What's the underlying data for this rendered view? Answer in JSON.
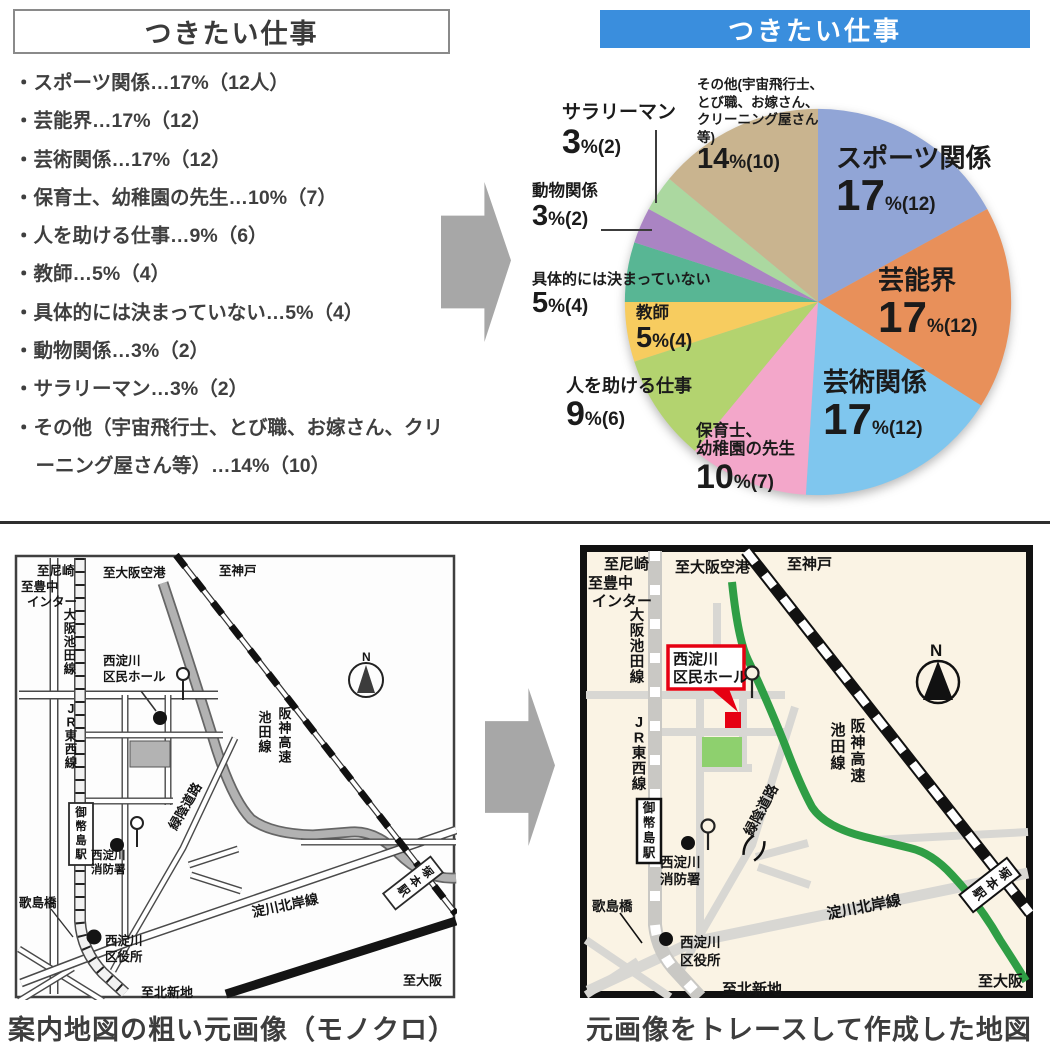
{
  "colors": {
    "header_blue": "#3a8edd",
    "map_green": "#2f9e45",
    "map_red": "#e60012",
    "park_green": "#8ed06e",
    "arrow_gray": "#a7a7a7"
  },
  "list_panel": {
    "title": "つきたい仕事",
    "items": [
      "スポーツ関係…17%（12人）",
      "芸能界…17%（12）",
      "芸術関係…17%（12）",
      "保育士、幼稚園の先生…10%（7）",
      "人を助ける仕事…9%（6）",
      "教師…5%（4）",
      "具体的には決まっていない…5%（4）",
      "動物関係…3%（2）",
      "サラリーマン…3%（2）",
      "その他（宇宙飛行士、とび職、お嫁さん、クリーニング屋さん等）…14%（10）"
    ]
  },
  "chart_header": {
    "title": "つきたい仕事"
  },
  "chart_data": {
    "type": "pie",
    "title": "つきたい仕事",
    "start_angle_deg": 0,
    "clockwise": true,
    "slices": [
      {
        "label": "スポーツ関係",
        "pct": 17,
        "count": 12,
        "big": "17",
        "small": "%(12)",
        "color": "#91a5d6"
      },
      {
        "label": "芸能界",
        "pct": 17,
        "count": 12,
        "big": "17",
        "small": "%(12)",
        "color": "#e8905a"
      },
      {
        "label": "芸術関係",
        "pct": 17,
        "count": 12,
        "big": "17",
        "small": "%(12)",
        "color": "#7fc6ee"
      },
      {
        "label": "保育士、幼稚園の先生",
        "pct": 10,
        "count": 7,
        "big": "10",
        "small": "%(7)",
        "color": "#f3a7ca",
        "label_lines": [
          "保育士、",
          "幼稚園の先生"
        ]
      },
      {
        "label": "人を助ける仕事",
        "pct": 9,
        "count": 6,
        "big": "9",
        "small": "%(6)",
        "color": "#b3d36f"
      },
      {
        "label": "教師",
        "pct": 5,
        "count": 4,
        "big": "5",
        "small": "%(4)",
        "color": "#f7cc5f"
      },
      {
        "label": "具体的には決まっていない",
        "pct": 5,
        "count": 4,
        "big": "5",
        "small": "%(4)",
        "color": "#58b694"
      },
      {
        "label": "動物関係",
        "pct": 3,
        "count": 2,
        "big": "3",
        "small": "%(2)",
        "color": "#aa84c3"
      },
      {
        "label": "サラリーマン",
        "pct": 3,
        "count": 2,
        "big": "3",
        "small": "%(2)",
        "color": "#abd8a0"
      },
      {
        "label": "その他(宇宙飛行士、とび職、お嫁さん、クリーニング屋さん等)",
        "pct": 14,
        "count": 10,
        "big": "14",
        "small": "%(10)",
        "color": "#c9b48f",
        "label_lines": [
          "その他(宇宙飛行士、",
          "とび職、お嫁さん、",
          "クリーニング屋さん",
          "等)"
        ]
      }
    ]
  },
  "maps": {
    "shared_labels": {
      "to_amagasaki": "至尼崎",
      "to_toyonaka_1": "至豊中",
      "to_toyonaka_2": "インター",
      "to_osaka_airport": "至大阪空港",
      "to_kobe": "至神戸",
      "osaka_ikeda_line": "大阪池田線",
      "jr_tozai_line": "JR東西線",
      "mitejima_station": "御幣島駅",
      "hall_line1": "西淀川",
      "hall_line2": "区民ホール",
      "hanshin_expwy": "阪神高速",
      "ikeda_line": "池田線",
      "ryokuin_road": "緑陰道路",
      "fire_line1": "西淀川",
      "fire_line2": "消防署",
      "utajima_bridge": "歌島橋",
      "ward_line1": "西淀川",
      "ward_line2": "区役所",
      "yodogawa_hokugan": "淀川北岸線",
      "tsukamoto_station": "塚本駅",
      "to_osaka": "至大阪",
      "to_kitashinchi": "至北新地",
      "compass_n": "N"
    },
    "left_caption": "案内地図の粗い元画像（モノクロ）",
    "right_caption": "元画像をトレースして作成した地図"
  }
}
